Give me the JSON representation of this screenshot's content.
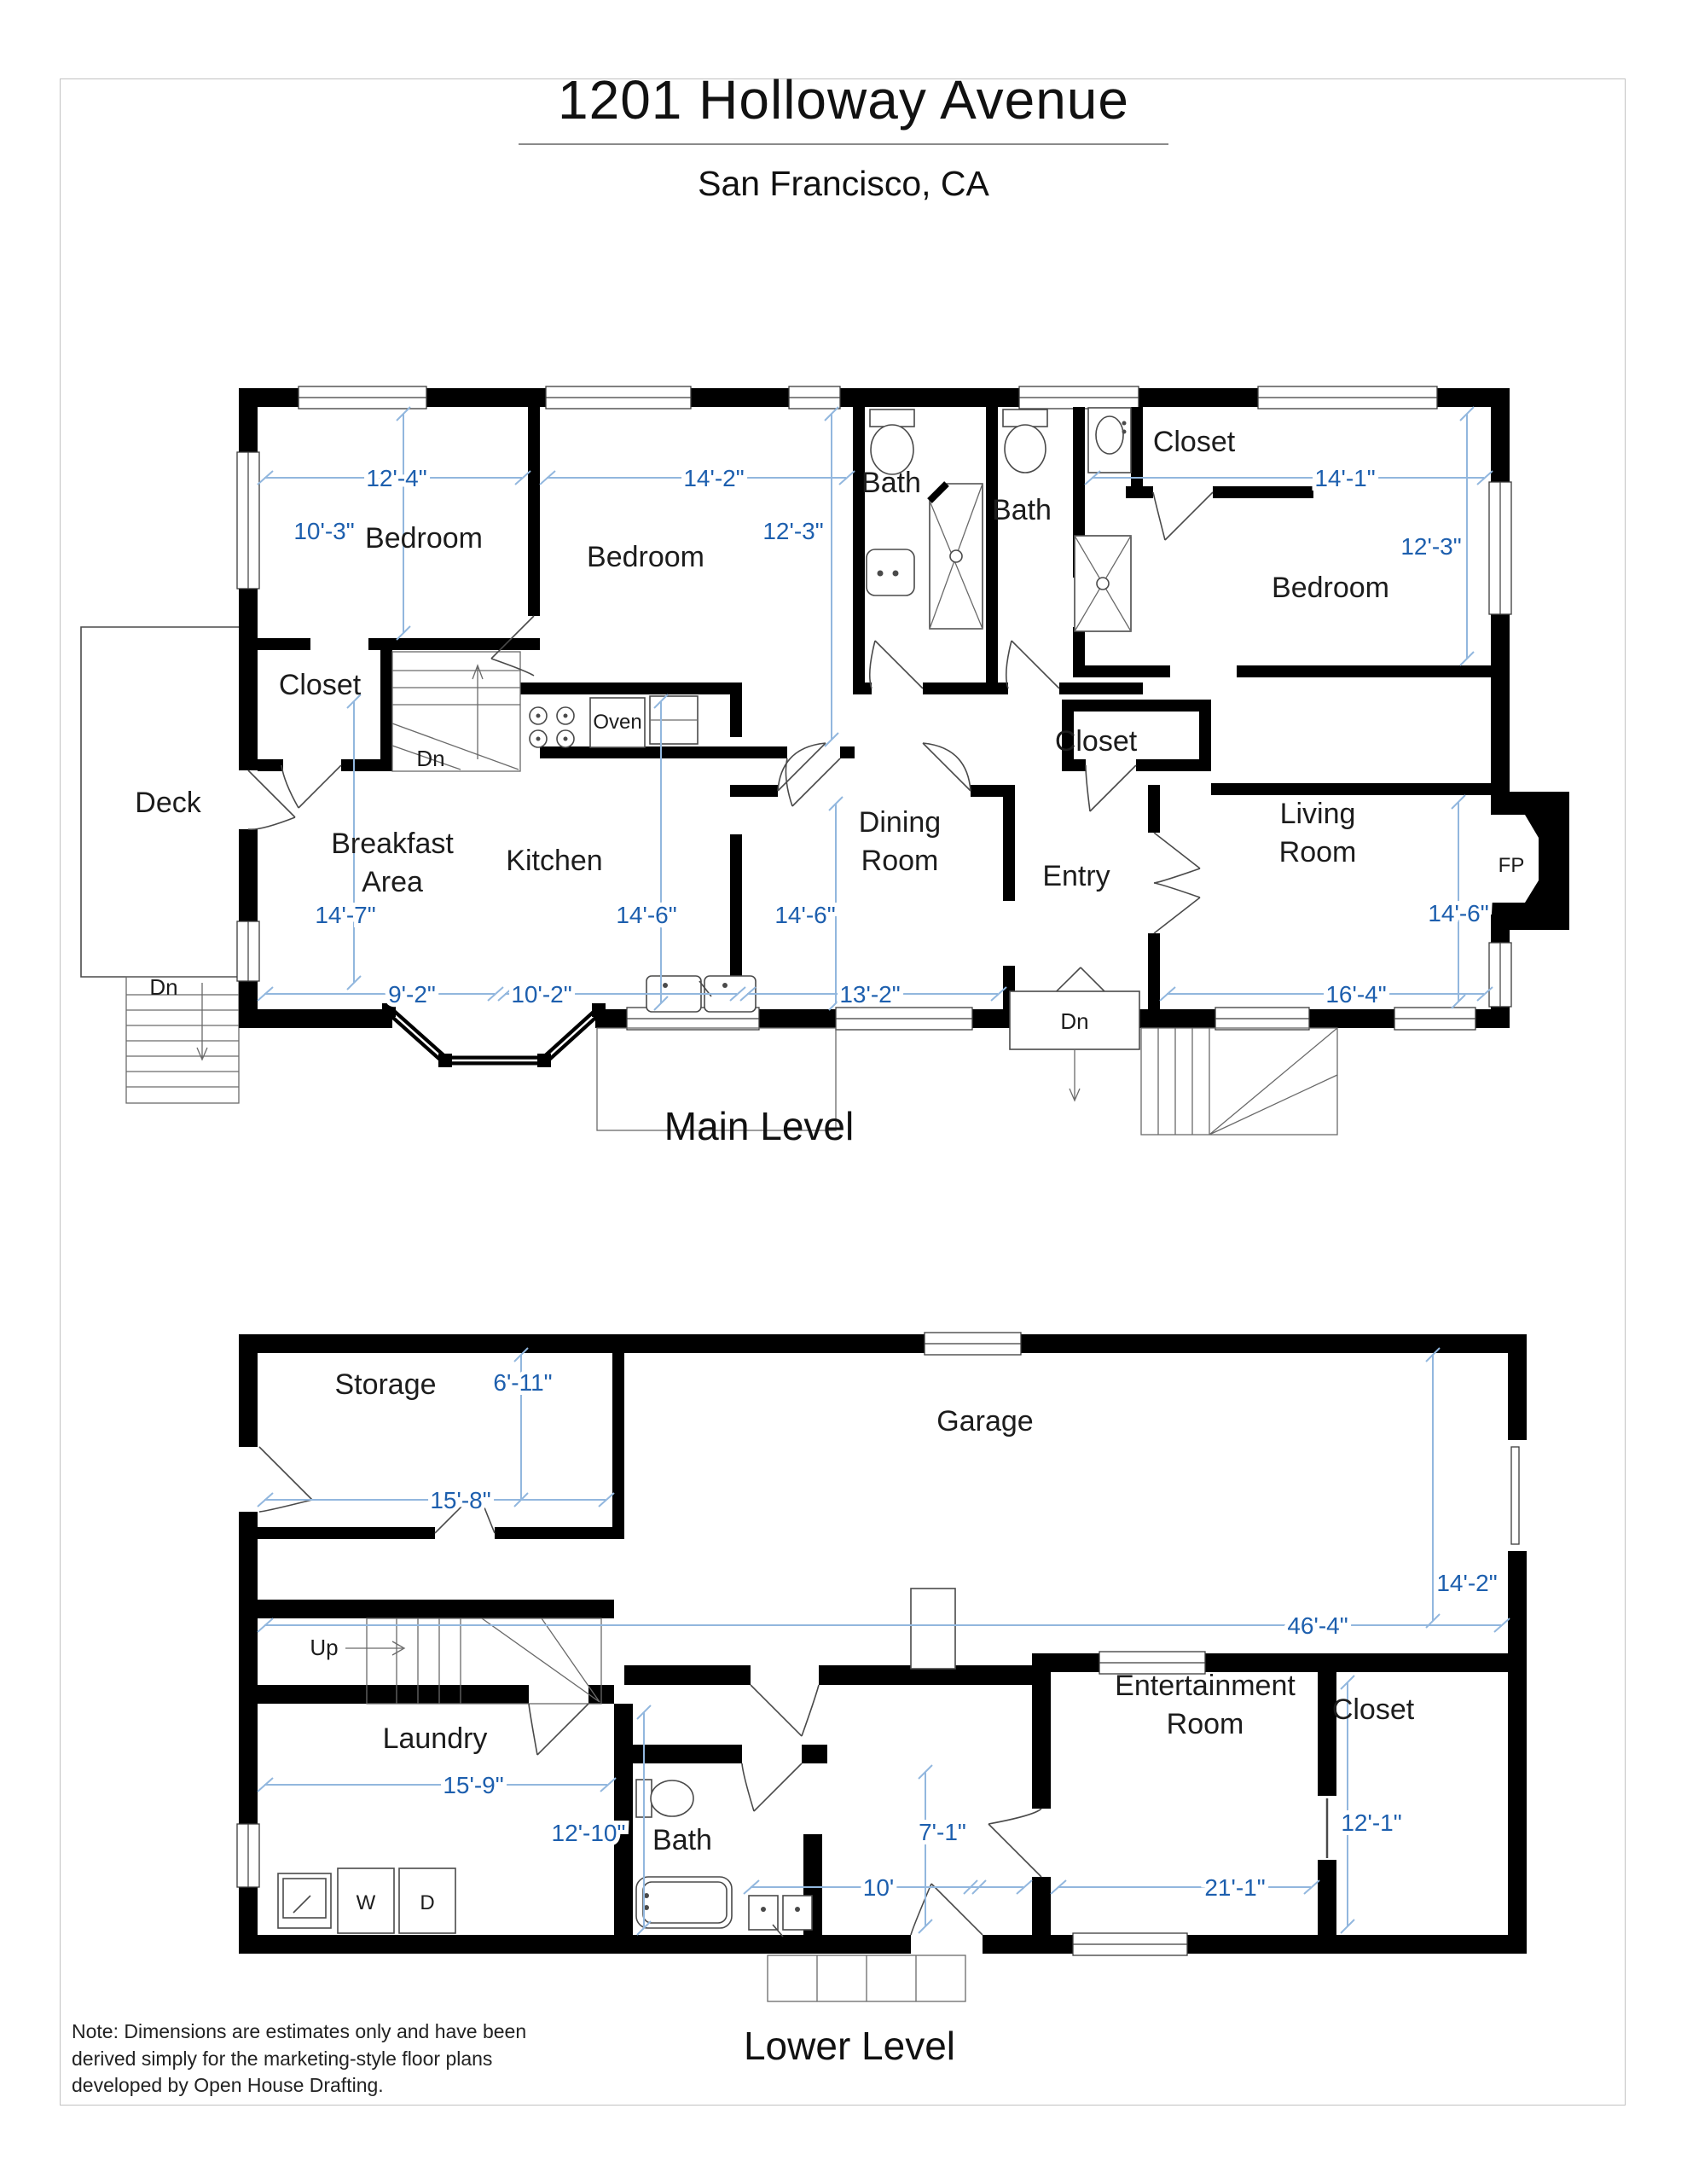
{
  "page": {
    "title": "1201 Holloway Avenue",
    "subtitle": "San Francisco, CA",
    "note": "Note: Dimensions are estimates only and have been derived simply for the marketing-style floor plans developed by Open House Drafting."
  },
  "colors": {
    "wall": "#000000",
    "dimension_text": "#1d5fae",
    "dimension_line": "#92b7de",
    "label": "#1c1c1c",
    "page_border": "#c2c2c2"
  },
  "main_level": {
    "title": "Main Level",
    "rooms": {
      "bedroom1": {
        "name": "Bedroom",
        "width": "12'-4\"",
        "depth": "10'-3\""
      },
      "bedroom2": {
        "name": "Bedroom",
        "width": "14'-2\"",
        "depth": "12'-3\""
      },
      "bedroom3": {
        "name": "Bedroom",
        "width": "14'-1\"",
        "depth": "12'-3\""
      },
      "bath1": {
        "name": "Bath"
      },
      "bath2": {
        "name": "Bath"
      },
      "closet_top": {
        "name": "Closet"
      },
      "closet_hall": {
        "name": "Closet"
      },
      "closet_entry": {
        "name": "Closet"
      },
      "deck": {
        "name": "Deck"
      },
      "breakfast": {
        "name": "Breakfast Area",
        "lines": [
          "Breakfast",
          "Area"
        ],
        "width": "9'-2\"",
        "depth": "14'-7\""
      },
      "kitchen": {
        "name": "Kitchen",
        "width": "10'-2\"",
        "depth": "14'-6\""
      },
      "dining": {
        "name": "Dining Room",
        "lines": [
          "Dining",
          "Room"
        ],
        "width": "13'-2\"",
        "depth": "14'-6\""
      },
      "entry": {
        "name": "Entry"
      },
      "living": {
        "name": "Living Room",
        "lines": [
          "Living",
          "Room"
        ],
        "width": "16'-4\"",
        "depth": "14'-6\""
      },
      "fireplace": {
        "name": "FP"
      }
    },
    "appliances": {
      "oven": "Oven"
    },
    "stairs": {
      "dn_hall": "Dn",
      "dn_deck": "Dn",
      "dn_front": "Dn"
    }
  },
  "lower_level": {
    "title": "Lower Level",
    "rooms": {
      "storage": {
        "name": "Storage",
        "width": "15'-8\"",
        "depth": "6'-11\""
      },
      "garage": {
        "name": "Garage",
        "width": "46'-4\"",
        "depth": "14'-2\""
      },
      "laundry": {
        "name": "Laundry",
        "width": "15'-9\"",
        "depth": "12'-10\""
      },
      "bath": {
        "name": "Bath",
        "width": "10'",
        "depth": "7'-1\""
      },
      "entertainment": {
        "name": "Entertainment Room",
        "lines": [
          "Entertainment",
          "Room"
        ],
        "width": "21'-1\"",
        "depth": "12'-1\""
      },
      "closet": {
        "name": "Closet"
      }
    },
    "appliances": {
      "washer": "W",
      "dryer": "D"
    },
    "stairs": {
      "up": "Up"
    }
  }
}
